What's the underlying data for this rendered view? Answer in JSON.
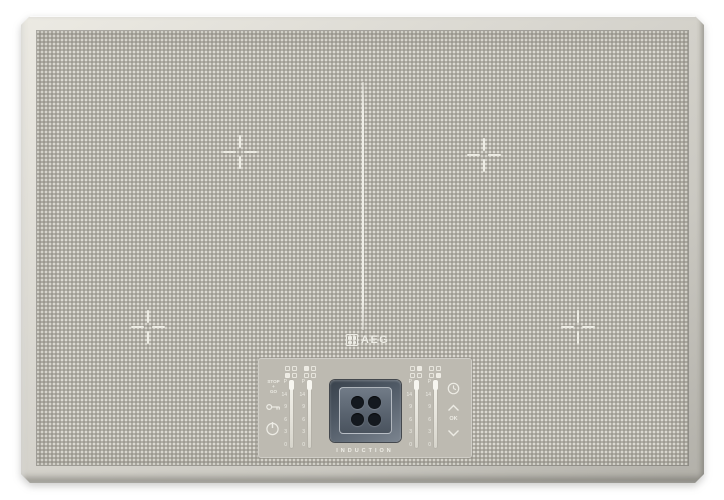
{
  "product": {
    "brand": "AEG",
    "type_label": "INDUCTION"
  },
  "colors": {
    "background": "#ffffff",
    "frame": "#d4d2cb",
    "glass": "#b1aea5",
    "control_panel": "#bdbab1",
    "markings": "#edece4",
    "display_body": "#4e5864",
    "display_screen": "#5d6773",
    "display_dots": "#14191f"
  },
  "markings": {
    "zone_crosshairs": 4,
    "center_divider_line": true
  },
  "display": {
    "zones_shown": 4
  },
  "controls": {
    "slider_ticks": [
      "P",
      "14",
      "9",
      "6",
      "3",
      "0"
    ],
    "stop_go": {
      "top": "STOP",
      "mid": "+",
      "bottom": "GO"
    },
    "ok_label": "OK",
    "icons": [
      "zone-selector-front-left-icon",
      "zone-selector-rear-left-icon",
      "zone-selector-rear-right-icon",
      "zone-selector-front-right-icon",
      "stop-go-button",
      "child-lock-key-icon",
      "power-icon",
      "timer-clock-icon",
      "chevron-up-icon",
      "ok-button",
      "chevron-down-icon"
    ]
  }
}
